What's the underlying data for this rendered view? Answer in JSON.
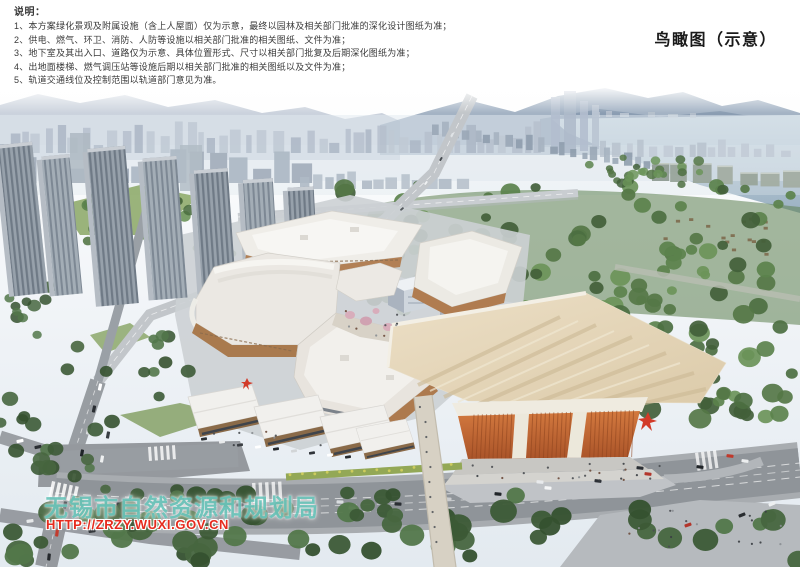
{
  "page": {
    "title": "鸟瞰图（示意）"
  },
  "notes": {
    "heading": "说明：",
    "items": [
      "1、本方案绿化景观及附属设施（含上人屋面）仅为示意，最终以园林及相关部门批准的深化设计图纸为准；",
      "2、供电、燃气、环卫、消防、人防等设施以相关部门批准的相关图纸、文件为准；",
      "3、地下室及其出入口、道路仅为示意、具体位置形式、尺寸以相关部门批复及后期深化图纸为准；",
      "4、出地面楼梯、燃气调压站等设施后期以相关部门批准的相关图纸以及文件为准；",
      "5、轨道交通线位及控制范围以轨道部门意见为准。"
    ]
  },
  "watermark": {
    "agency": "无锡市自然资源和规划局",
    "url": "HTTP://ZRZY.WUXI.GOV.CN"
  },
  "colors": {
    "title_ink": "#1a1a1a",
    "note_ink": "#3a3a3a",
    "watermark_teal": "#6ec7bd",
    "watermark_red": "#e62b1e",
    "mall_facade_tan": "#b28055",
    "hall_facade_orange": "#c06838",
    "sculpture_red": "#d23a28",
    "lake_blue": "#a9bfcf",
    "mountain_blue": "#8da0b5",
    "greenery_green": "#52774a",
    "road_grey": "#8f9499"
  }
}
